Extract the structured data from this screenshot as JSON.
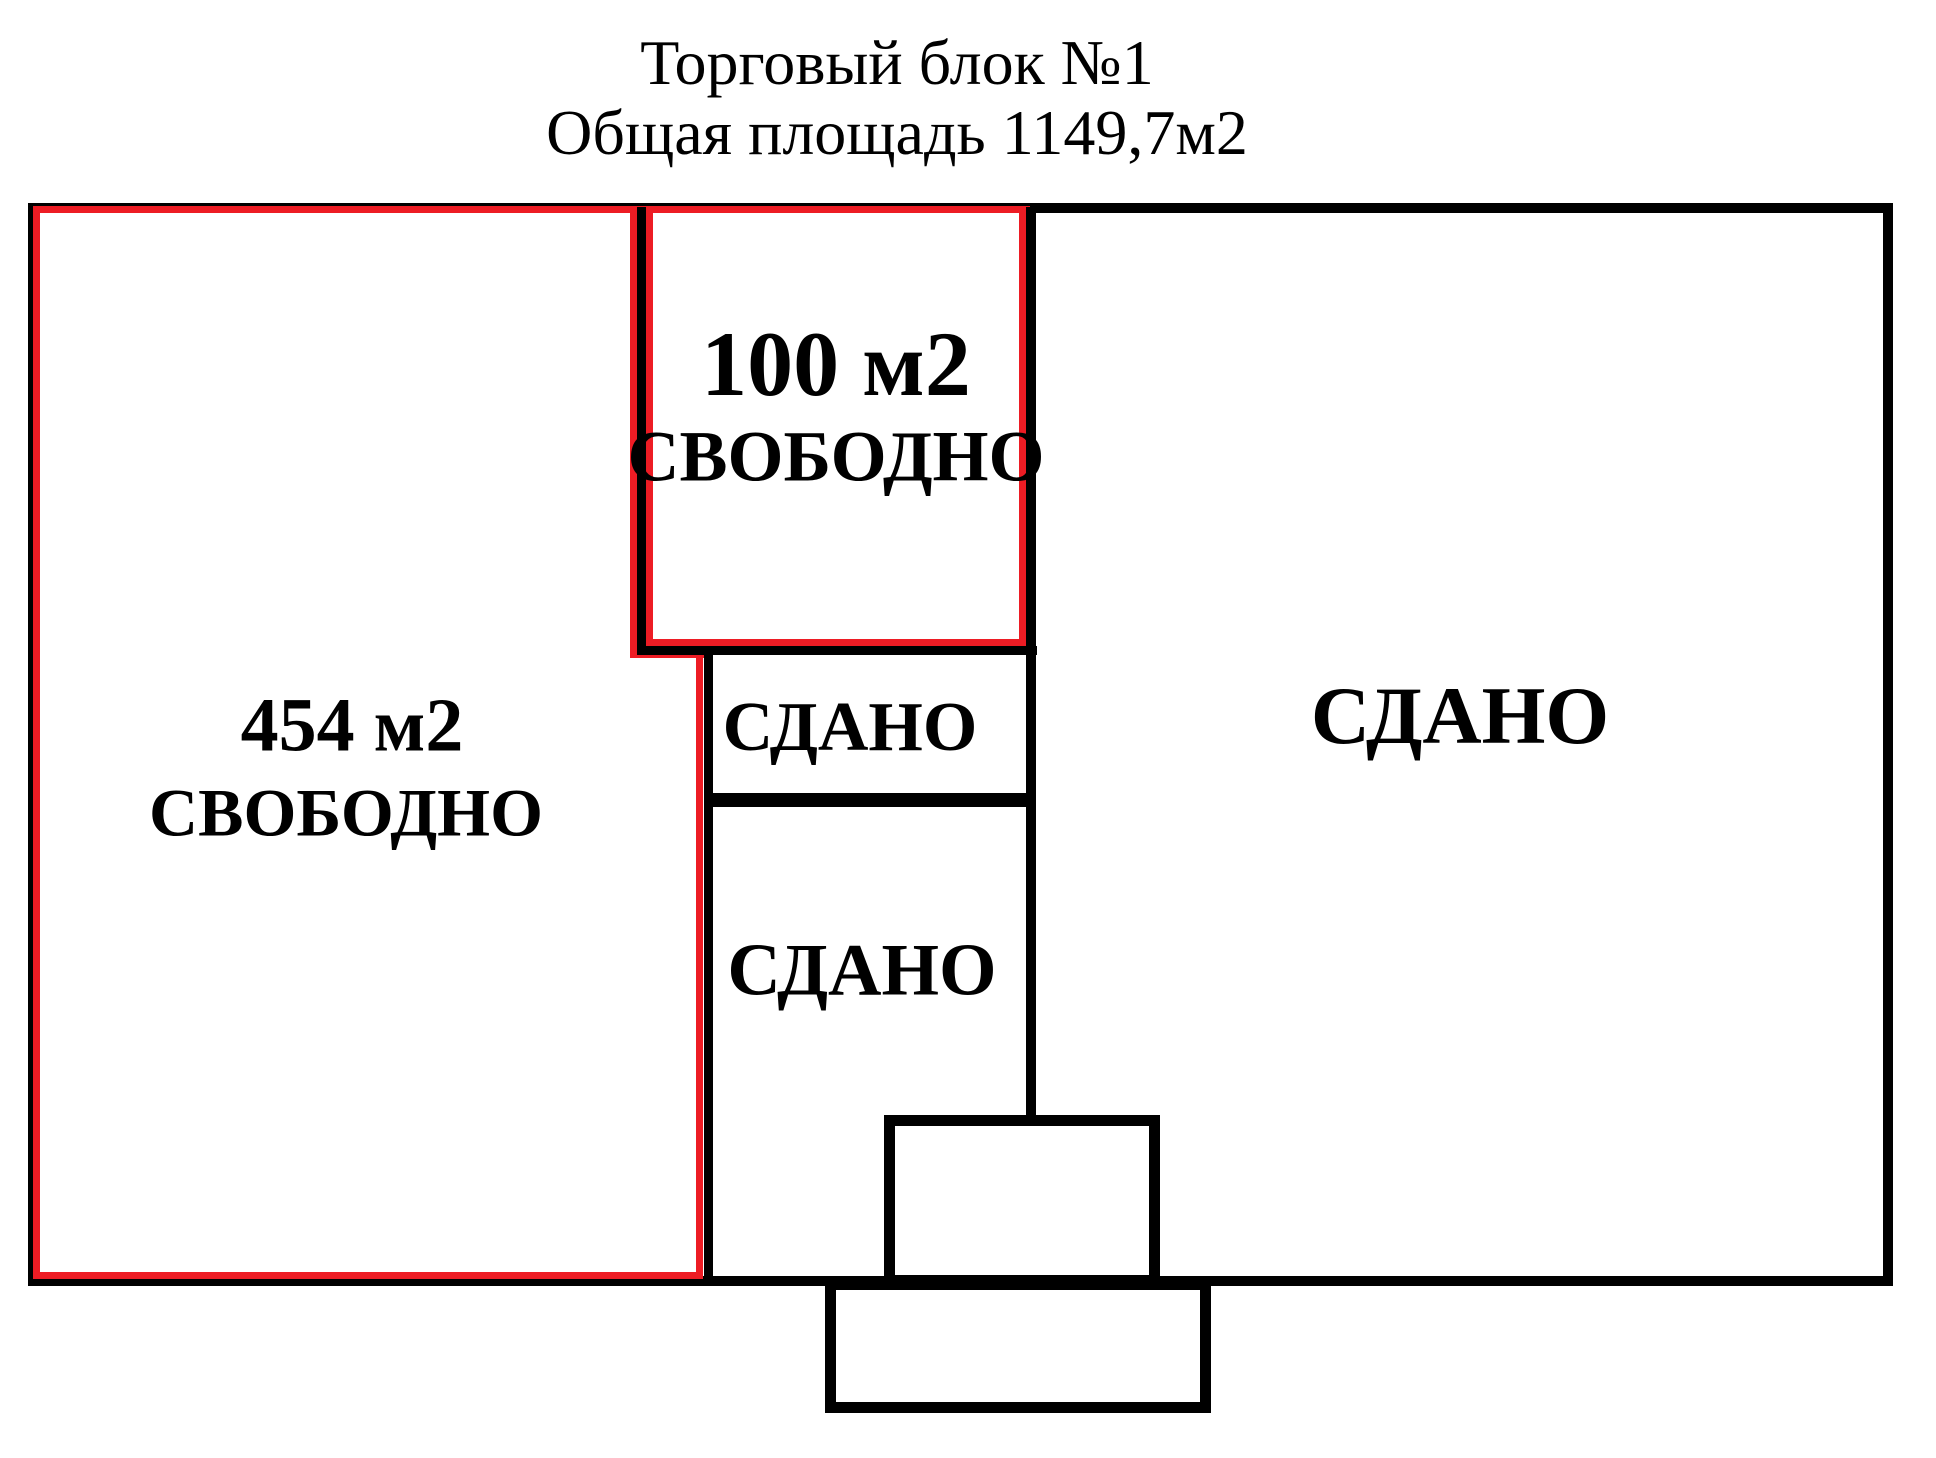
{
  "title": {
    "line1": "Торговый блок №1",
    "line2": "Общая площадь 1149,7м2"
  },
  "rooms": {
    "left_free": {
      "area": "454 м2",
      "status": "СВОБОДНО"
    },
    "top_free": {
      "area": "100 м2",
      "status": "СВОБОДНО"
    },
    "middle_upper_leased": {
      "status": "СДАНО"
    },
    "middle_lower_leased": {
      "status": "СДАНО"
    },
    "right_leased": {
      "status": "СДАНО"
    }
  },
  "colors": {
    "free_outline": "#ed1c24",
    "walls": "#000000",
    "background": "#ffffff"
  }
}
